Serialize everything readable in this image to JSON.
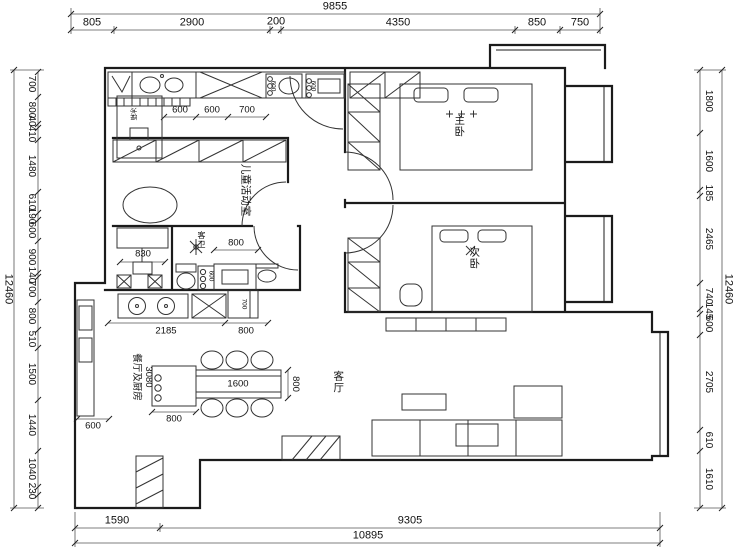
{
  "labels": {
    "master_bedroom": "主卧",
    "second_bedroom": "次卧",
    "living_room": "客厅",
    "children_room": "儿童活动室",
    "dining_kitchen": "餐厅及厨房",
    "guest_bath": "客卫",
    "fridge": "冰箱"
  },
  "dims": {
    "top": {
      "total": "9855",
      "segments": [
        "805",
        "2900",
        "200",
        "4350",
        "850",
        "750"
      ]
    },
    "left": {
      "total": "12460",
      "segments": [
        "700",
        "800",
        "40",
        "410",
        "1480",
        "610",
        "190",
        "600",
        "900",
        "140",
        "700",
        "800",
        "510",
        "1500",
        "1440",
        "1040",
        "230"
      ]
    },
    "right": {
      "total": "12460",
      "segments": [
        "1800",
        "1600",
        "185",
        "2465",
        "740",
        "145",
        "600",
        "2705",
        "610",
        "1610"
      ]
    },
    "bottom": {
      "total": "10895",
      "segments": [
        "1590",
        "9305"
      ]
    },
    "interior": {
      "counter_a": "600",
      "counter_b": "600",
      "counter_c": "700",
      "appliance_a": "600",
      "appliance_b": "600",
      "desk": "830",
      "bath": "800",
      "washer": "600",
      "box": "700",
      "kitchen_run": "2185",
      "kitchen_end": "800",
      "dining_depth": "3080",
      "table_len": "1600",
      "table_side": "800",
      "sideboard": "800",
      "balcony": "600"
    }
  }
}
